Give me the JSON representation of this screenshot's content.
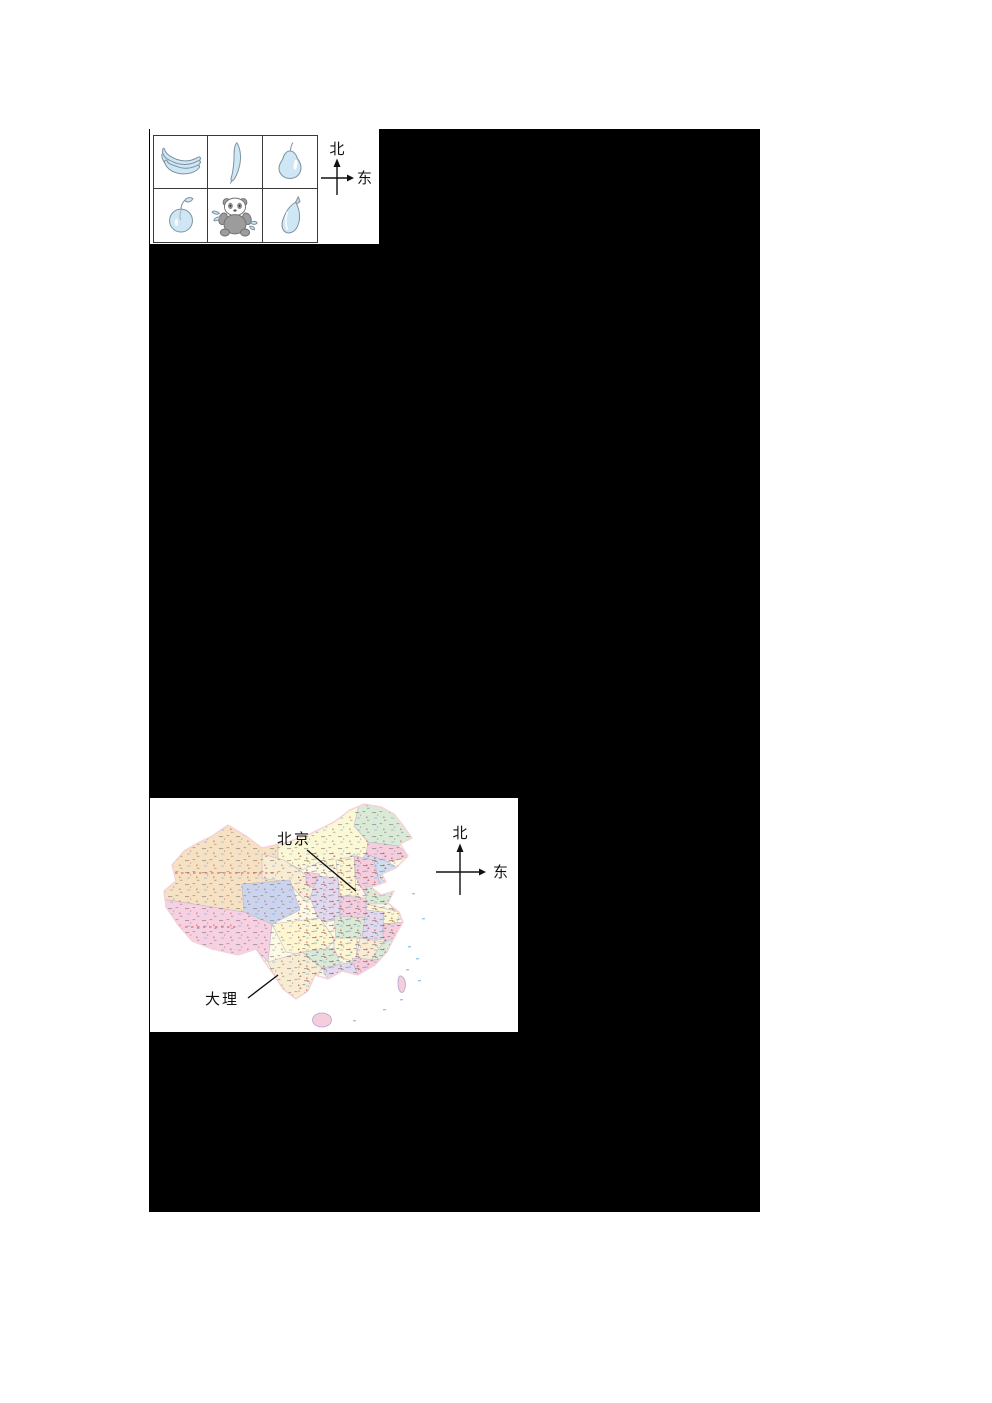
{
  "theme": {
    "page_bg": "#ffffff",
    "redaction_bg": "#000000",
    "panel_bg": "#ffffff",
    "grid_border": "#3a3a3a",
    "art_fill": "#cfe7f5",
    "art_stroke": "#7d92a0",
    "panda_gray": "#9c9c9c",
    "panda_dark": "#6f6f6f",
    "arrow_color": "#111111",
    "label_color": "#111111",
    "map_border": "#b3a1d2"
  },
  "fruit_panel": {
    "cells": [
      {
        "icon": "bananas-icon"
      },
      {
        "icon": "cucumber-icon"
      },
      {
        "icon": "pear-icon"
      },
      {
        "icon": "peach-icon"
      },
      {
        "icon": "panda-icon"
      },
      {
        "icon": "eggplant-icon"
      }
    ],
    "compass": {
      "north": "北",
      "east": "东"
    }
  },
  "map_panel": {
    "labels": {
      "beijing": "北京",
      "dali": "大理"
    },
    "compass": {
      "north": "北",
      "east": "东"
    },
    "palette": {
      "base": "#fdf9e3",
      "xinjiang": "#f6e2c3",
      "inner_mongolia": "#fbf8d6",
      "heilongjiang": "#d9ead6",
      "jilin": "#f5cede",
      "liaoning": "#cfdfee",
      "qinghai": "#cbd4ec",
      "tibet": "#f6d1e1",
      "gansu": "#f8ecd2",
      "ningxia": "#f5cede",
      "shaanxi": "#e3d9ef",
      "shanxi": "#fdf6d0",
      "hebei": "#f5cede",
      "henan": "#f5cede",
      "shandong": "#d9ead6",
      "hubei": "#d9ead6",
      "sichuan": "#fdf6d0",
      "jiangsu": "#fdf6d0",
      "anhui": "#e3d9ef",
      "zhejiang": "#f5cede",
      "jiangxi": "#f8ecd2",
      "hunan": "#fdf6d0",
      "guizhou": "#d9ead6",
      "yunnan": "#f8ecd2",
      "fujian": "#d9ead6",
      "guangxi": "#e3d9ef",
      "guangdong": "#f5cede",
      "taiwan": "#f5cede",
      "hainan": "#f5cede",
      "sea_mark": "#9cc8e8",
      "red_route": "#e05050"
    }
  }
}
